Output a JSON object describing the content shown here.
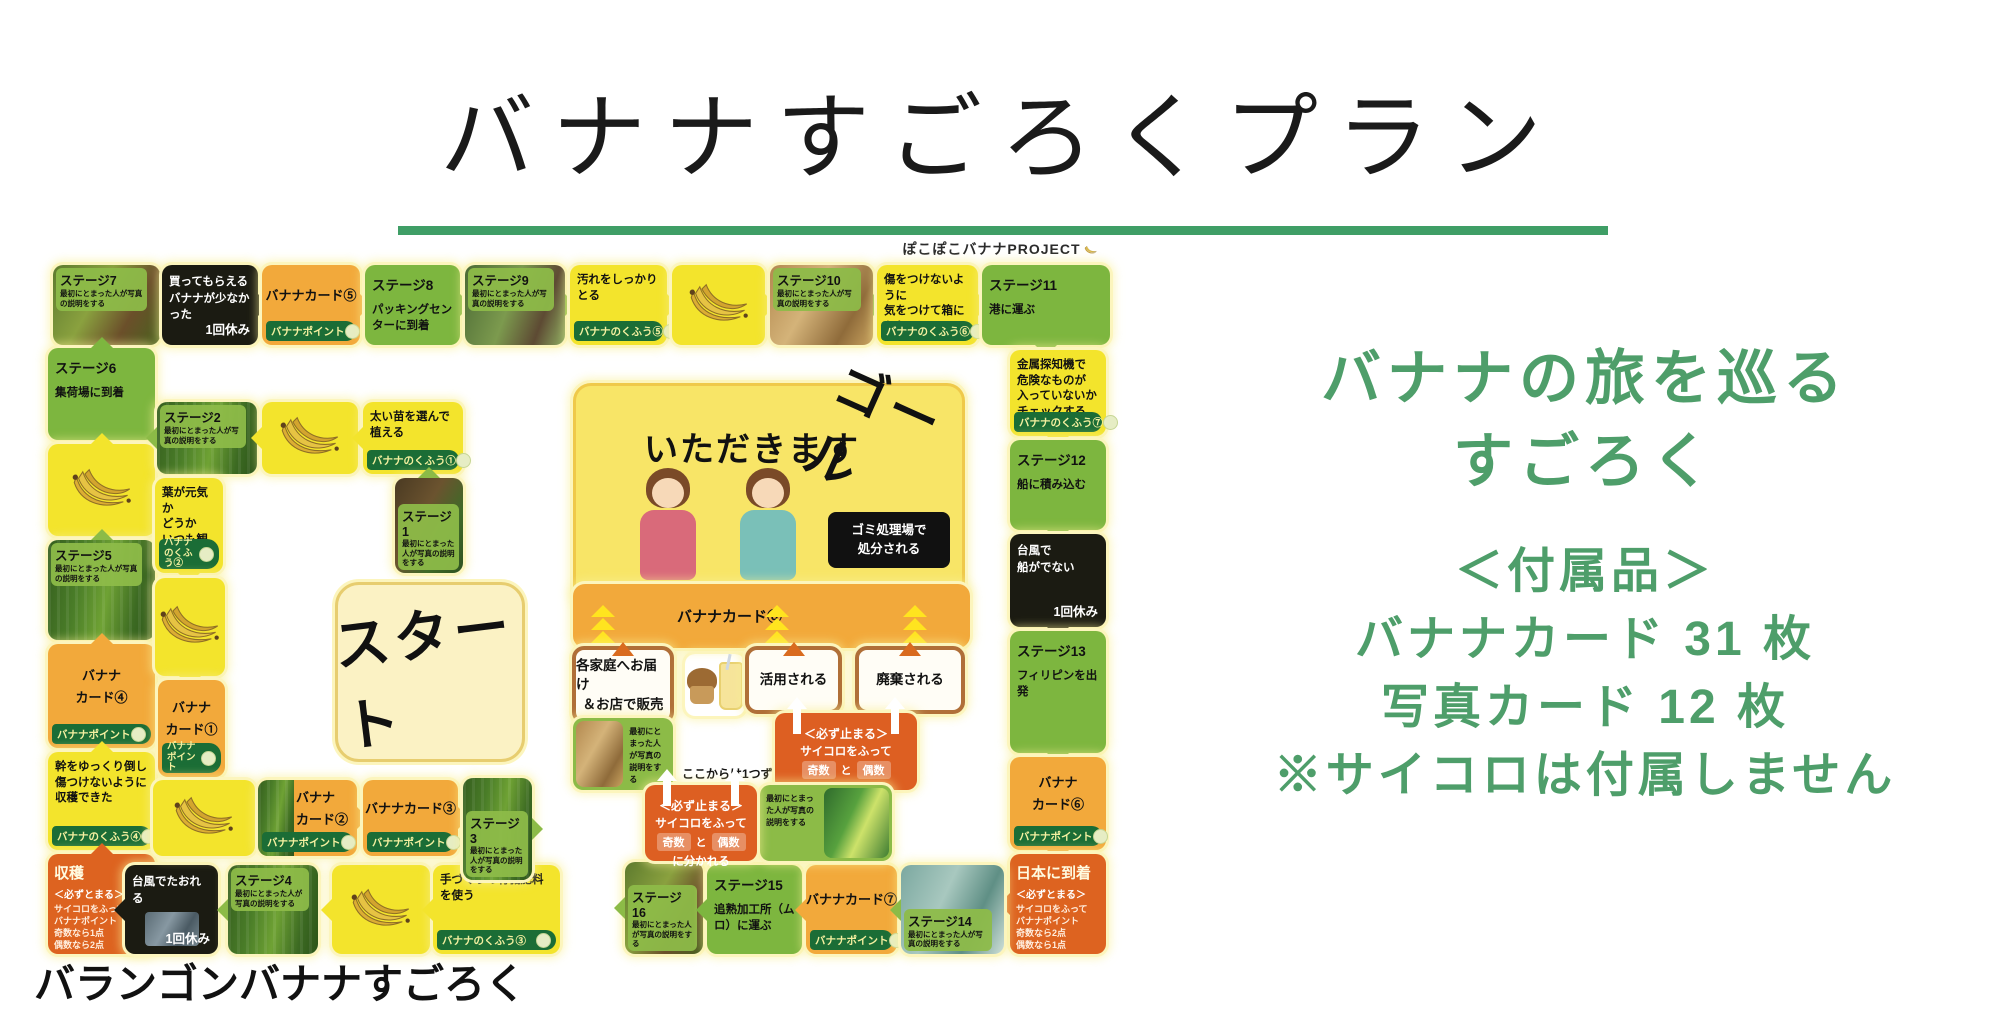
{
  "title": "バナナすごろくプラン",
  "subtitle": "ぽこぽこバナナPROJECT",
  "caption": "バランゴンバナナすごろく",
  "right_panel": {
    "line1": "バナナの旅を巡る",
    "line2": "すごろく",
    "line3": "＜付属品＞",
    "line4": "バナナカード 31 枚",
    "line5": "写真カード 12 枚",
    "line6": "※サイコロは付属しません"
  },
  "colors": {
    "accent_green": "#3f9e66",
    "panel_text_green": "#4e9e6a",
    "tile_yellow": "#f3e42c",
    "tile_orange": "#f2a93b",
    "tile_green": "#7db63f",
    "photo_tile_green": "#8cbb47",
    "band_green": "#1b6d36",
    "event_black": "#1b1b12",
    "corner_orange": "#dd6320",
    "split_orange": "#dd5f22"
  },
  "board": {
    "tiles": [
      {
        "id": "tile-stage-7",
        "type": "photo-stage",
        "x": 13,
        "y": 3,
        "w": 107,
        "h": 80,
        "stage": "ステージ7",
        "desc": "最初にとまった人が写真の説明をする",
        "photo": "market",
        "label": "top",
        "arrow": "right"
      },
      {
        "id": "tile-event-few-bananas",
        "type": "black",
        "x": 122,
        "y": 3,
        "w": 96,
        "h": 80,
        "lines": [
          "買ってもらえる",
          "バナナが少なかった"
        ],
        "note": "1回休み",
        "arrow": "right"
      },
      {
        "id": "tile-card-5",
        "type": "card",
        "x": 222,
        "y": 3,
        "w": 98,
        "h": 80,
        "lines": [
          "バナナカード⑤"
        ],
        "band": "バナナポイント",
        "arrow": "right"
      },
      {
        "id": "tile-stage-8",
        "type": "stage",
        "x": 325,
        "y": 3,
        "w": 95,
        "h": 80,
        "title": "ステージ8",
        "desc": "パッキングセンターに到着",
        "arrow": "right"
      },
      {
        "id": "tile-stage-9",
        "type": "photo-stage",
        "x": 425,
        "y": 3,
        "w": 100,
        "h": 80,
        "stage": "ステージ9",
        "desc": "最初にとまった人が写真の説明をする",
        "photo": "packing",
        "label": "top",
        "arrow": "right"
      },
      {
        "id": "tile-kufu-5",
        "type": "action",
        "x": 530,
        "y": 3,
        "w": 97,
        "h": 80,
        "lines": [
          "汚れをしっかりとる"
        ],
        "band": "バナナのくふう⑤",
        "arrow": "right"
      },
      {
        "id": "tile-banana-top",
        "type": "banana",
        "x": 632,
        "y": 3,
        "w": 93,
        "h": 80,
        "arrow": "right"
      },
      {
        "id": "tile-stage-10",
        "type": "photo-stage",
        "x": 730,
        "y": 3,
        "w": 103,
        "h": 80,
        "stage": "ステージ10",
        "desc": "最初にとまった人が写真の説明をする",
        "photo": "boxes",
        "label": "top",
        "arrow": "right"
      },
      {
        "id": "tile-kufu-6",
        "type": "action",
        "x": 837,
        "y": 3,
        "w": 101,
        "h": 80,
        "lines": [
          "傷をつけないように",
          "気をつけて箱に入れる"
        ],
        "band": "バナナのくふう⑥",
        "arrow": "right"
      },
      {
        "id": "tile-stage-11",
        "type": "stage",
        "x": 942,
        "y": 3,
        "w": 128,
        "h": 80,
        "title": "ステージ11",
        "desc": "港に運ぶ",
        "arrow": "down"
      },
      {
        "id": "tile-kufu-7",
        "type": "action",
        "x": 970,
        "y": 88,
        "w": 96,
        "h": 86,
        "lines": [
          "金属探知機で",
          "危険なものが",
          "入っていないか",
          "チェックする"
        ],
        "band": "バナナのくふう⑦",
        "arrow": "down"
      },
      {
        "id": "tile-stage-12",
        "type": "stage",
        "x": 970,
        "y": 178,
        "w": 96,
        "h": 90,
        "title": "ステージ12",
        "desc": "船に積み込む",
        "arrow": "down"
      },
      {
        "id": "tile-event-ship",
        "type": "black",
        "x": 970,
        "y": 272,
        "w": 96,
        "h": 93,
        "lines": [
          "台風で",
          "船がでない"
        ],
        "note": "1回休み",
        "arrow": "down"
      },
      {
        "id": "tile-stage-13",
        "type": "stage",
        "x": 970,
        "y": 369,
        "w": 96,
        "h": 122,
        "title": "ステージ13",
        "desc": "フィリピンを出発",
        "arrow": "down"
      },
      {
        "id": "tile-card-6",
        "type": "card",
        "x": 970,
        "y": 495,
        "w": 96,
        "h": 93,
        "lines": [
          "バナナ",
          "カード⑥"
        ],
        "band": "バナナポイント",
        "arrow": "down"
      },
      {
        "id": "tile-arrive-japan",
        "type": "corner",
        "x": 970,
        "y": 592,
        "w": 96,
        "h": 100,
        "title": "日本に到着",
        "sub": "＜必ずとまる＞",
        "lines": [
          "サイコロをふって",
          "バナナポイント",
          "奇数なら2点",
          "偶数なら1点"
        ],
        "arrow": "left"
      },
      {
        "id": "tile-stage-6",
        "type": "stage",
        "x": 8,
        "y": 86,
        "w": 107,
        "h": 92,
        "title": "ステージ6",
        "desc": "集荷場に到着",
        "arrow": "up"
      },
      {
        "id": "tile-banana-left",
        "type": "banana",
        "x": 8,
        "y": 182,
        "w": 107,
        "h": 92,
        "arrow": "up"
      },
      {
        "id": "tile-stage-5",
        "type": "photo-stage",
        "x": 8,
        "y": 278,
        "w": 107,
        "h": 100,
        "stage": "ステージ5",
        "desc": "最初にとまった人が写真の説明をする",
        "photo": "plantation",
        "label": "top",
        "arrow": "up"
      },
      {
        "id": "tile-card-4",
        "type": "card",
        "x": 8,
        "y": 382,
        "w": 107,
        "h": 104,
        "lines": [
          "バナナ",
          "カード④"
        ],
        "band": "バナナポイント",
        "arrow": "up"
      },
      {
        "id": "tile-kufu-4",
        "type": "action",
        "x": 8,
        "y": 490,
        "w": 107,
        "h": 98,
        "lines": [
          "幹をゆっくり倒し",
          "傷つけないように",
          "収穫できた"
        ],
        "band": "バナナのくふう④",
        "arrow": "up"
      },
      {
        "id": "tile-harvest",
        "type": "corner",
        "x": 8,
        "y": 592,
        "w": 107,
        "h": 100,
        "title": "収穫",
        "sub": "＜必ずとまる＞",
        "lines": [
          "サイコロをふって",
          "バナナポイント",
          "奇数なら1点",
          "偶数なら2点"
        ],
        "arrow": "up"
      },
      {
        "id": "tile-event-typhoon",
        "type": "black",
        "x": 85,
        "y": 603,
        "w": 93,
        "h": 89,
        "lines": [
          "台風でたおれる"
        ],
        "note": "1回休み",
        "photo": "storm",
        "arrow": "left"
      },
      {
        "id": "tile-stage-4",
        "type": "photo-stage",
        "x": 188,
        "y": 603,
        "w": 90,
        "h": 89,
        "stage": "ステージ4",
        "desc": "最初にとまった人が写真の説明をする",
        "photo": "plantation",
        "label": "top",
        "arrow": "left"
      },
      {
        "id": "tile-banana-bottom",
        "type": "banana",
        "x": 292,
        "y": 603,
        "w": 98,
        "h": 89,
        "arrow": "left"
      },
      {
        "id": "tile-kufu-3",
        "type": "action",
        "x": 393,
        "y": 603,
        "w": 127,
        "h": 89,
        "lines": [
          "手づくりの有機肥料",
          "を使う"
        ],
        "band": "バナナのくふう③",
        "arrow": "left"
      },
      {
        "id": "tile-stage-16",
        "type": "photo-stage",
        "x": 585,
        "y": 600,
        "w": 78,
        "h": 92,
        "stage": "ステージ16",
        "desc": "最初にとまった人が写真の説明をする",
        "photo": "market",
        "label": "bottom",
        "arrow": "left"
      },
      {
        "id": "tile-stage-15",
        "type": "stage",
        "x": 667,
        "y": 603,
        "w": 95,
        "h": 89,
        "title": "ステージ15",
        "desc": "追熟加工所（ムロ）に運ぶ",
        "arrow": "left"
      },
      {
        "id": "tile-card-7",
        "type": "card",
        "x": 766,
        "y": 603,
        "w": 91,
        "h": 89,
        "lines": [
          "バナナカード⑦"
        ],
        "band": "バナナポイント",
        "arrow": "left"
      },
      {
        "id": "tile-stage-14",
        "type": "photo-stage",
        "x": 861,
        "y": 603,
        "w": 103,
        "h": 89,
        "stage": "ステージ14",
        "desc": "最初にとまった人が写真の説明をする",
        "photo": "factory",
        "label": "bottom",
        "arrow": "left"
      },
      {
        "id": "tile-stage-2",
        "type": "photo-stage",
        "x": 117,
        "y": 140,
        "w": 100,
        "h": 72,
        "stage": "ステージ2",
        "desc": "最初にとまった人が写真の説明をする",
        "photo": "plantation",
        "label": "top",
        "arrow": "left"
      },
      {
        "id": "tile-banana-inner-top",
        "type": "banana",
        "x": 222,
        "y": 140,
        "w": 96,
        "h": 72,
        "arrow": "left"
      },
      {
        "id": "tile-kufu-1",
        "type": "action",
        "x": 323,
        "y": 140,
        "w": 100,
        "h": 72,
        "lines": [
          "太い苗を選んで植える"
        ],
        "band": "バナナのくふう①",
        "arrow": "left"
      },
      {
        "id": "tile-stage-1",
        "type": "photo-stage",
        "x": 355,
        "y": 216,
        "w": 68,
        "h": 95,
        "stage": "ステージ1",
        "desc": "最初にとまった人が写真の説明をする",
        "photo": "soil",
        "label": "bottom",
        "arrow": "up"
      },
      {
        "id": "tile-kufu-2",
        "type": "action",
        "x": 115,
        "y": 216,
        "w": 68,
        "h": 95,
        "lines": [
          "葉が元気か",
          "どうか",
          "いつも観察"
        ],
        "band": "バナナのくふう②",
        "arrow": "down"
      },
      {
        "id": "tile-banana-inner-left",
        "type": "banana",
        "x": 115,
        "y": 316,
        "w": 70,
        "h": 98,
        "arrow": "down"
      },
      {
        "id": "tile-card-1",
        "type": "card",
        "x": 118,
        "y": 418,
        "w": 67,
        "h": 97,
        "lines": [
          "バナナ",
          "カード①"
        ],
        "band": "バナナポイント",
        "arrow": "down"
      },
      {
        "id": "tile-banana-inner-bottom",
        "type": "banana",
        "x": 113,
        "y": 518,
        "w": 102,
        "h": 76,
        "arrow": "right"
      },
      {
        "id": "tile-card-2",
        "type": "card",
        "x": 218,
        "y": 518,
        "w": 99,
        "h": 76,
        "lines": [
          "バナナ",
          "カード②"
        ],
        "band": "バナナポイント",
        "photo": "plantation",
        "arrow": "right"
      },
      {
        "id": "tile-card-3",
        "type": "card",
        "x": 323,
        "y": 518,
        "w": 95,
        "h": 76,
        "lines": [
          "バナナカード③"
        ],
        "band": "バナナポイント",
        "arrow": "right"
      },
      {
        "id": "tile-stage-3",
        "type": "photo-stage",
        "x": 423,
        "y": 516,
        "w": 69,
        "h": 102,
        "stage": "ステージ3",
        "desc": "最初にとまった人が写真の説明をする",
        "photo": "plantation",
        "label": "bottom",
        "arrow": "right"
      },
      {
        "id": "board-start",
        "type": "start",
        "x": 295,
        "y": 320,
        "w": 190,
        "h": 180,
        "text": "スタート"
      },
      {
        "id": "board-goal",
        "type": "goal",
        "x": 533,
        "y": 121,
        "w": 392,
        "h": 225,
        "goal_text": "ゴール",
        "heading": "いただきます",
        "black_lines": [
          "ゴミ処理場で",
          "処分される"
        ]
      },
      {
        "id": "tile-card-8-bar",
        "type": "bar",
        "x": 533,
        "y": 322,
        "w": 397,
        "h": 64,
        "text": "バナナカード⑧"
      },
      {
        "id": "tile-delivery",
        "type": "white",
        "x": 532,
        "y": 384,
        "w": 102,
        "h": 78,
        "lines": [
          "各家庭へお届け",
          "＆お店で販売"
        ]
      },
      {
        "id": "tile-snack-illustration",
        "type": "deco-snack",
        "x": 645,
        "y": 392,
        "w": 60,
        "h": 62
      },
      {
        "id": "tile-used",
        "type": "white",
        "x": 705,
        "y": 384,
        "w": 97,
        "h": 68,
        "lines": [
          "活用される"
        ]
      },
      {
        "id": "tile-discarded",
        "type": "white",
        "x": 815,
        "y": 384,
        "w": 110,
        "h": 68,
        "lines": [
          "廃棄される"
        ]
      },
      {
        "id": "tile-photo-delivery",
        "type": "photolabel",
        "x": 533,
        "y": 456,
        "w": 100,
        "h": 72,
        "desc": "最初にとまった人が写真の説明をする",
        "photo": "boxes",
        "side": "right"
      },
      {
        "id": "board-note",
        "type": "note",
        "x": 642,
        "y": 503,
        "w": 140,
        "h": 18,
        "text": "ここからは1つずつ進む"
      },
      {
        "id": "tile-split-upper",
        "type": "red",
        "x": 735,
        "y": 451,
        "w": 142,
        "h": 77,
        "title": "＜必ず止まる＞",
        "line2": "サイコロをふって",
        "odd": "奇数",
        "mid": "と",
        "even": "偶数",
        "line4": "に分かれる"
      },
      {
        "id": "tile-photo-crates",
        "type": "photolabel",
        "x": 720,
        "y": 523,
        "w": 132,
        "h": 76,
        "desc": "最初にとまった人が写真の説明をする",
        "photo": "crates",
        "side": "left"
      },
      {
        "id": "tile-split-lower",
        "type": "red",
        "x": 605,
        "y": 523,
        "w": 112,
        "h": 76,
        "title": "＜必ず止まる＞",
        "line2": "サイコロをふって",
        "odd": "奇数",
        "mid": "と",
        "even": "偶数",
        "line4": "に分かれる"
      }
    ]
  }
}
